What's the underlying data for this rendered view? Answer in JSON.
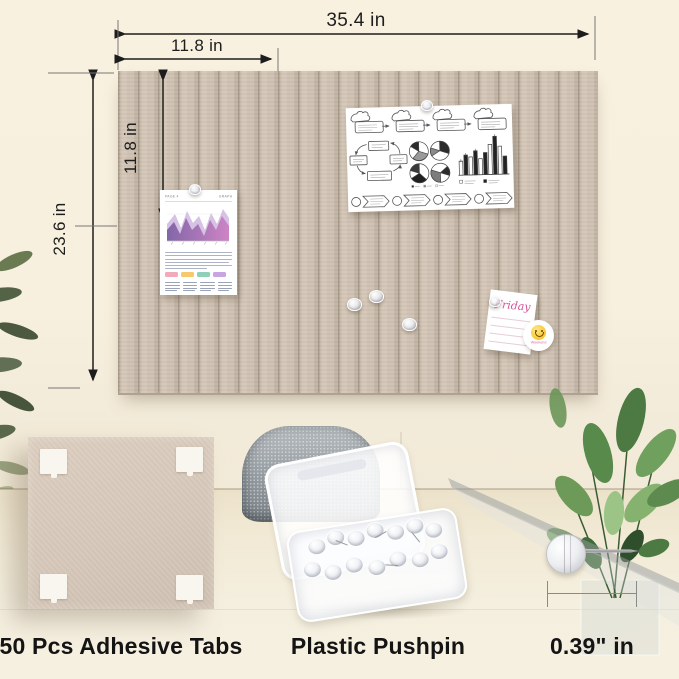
{
  "annotations": {
    "board_width": "35.4 in",
    "panel_width": "11.8 in",
    "panel_height": "11.8 in",
    "board_height": "23.6 in"
  },
  "board": {
    "slat_color": "#cfc2b3",
    "groove_color": "#a69888",
    "slat_count": 24
  },
  "pinned_items": {
    "graph_page": {
      "header_left": "PAGE 4",
      "header_right": "GRAPH",
      "ribbon_colors": [
        "#f2a9bb",
        "#f6c96f",
        "#8fd0b8",
        "#c9a4e2"
      ]
    },
    "friday_note": {
      "title": "Friday",
      "sticker_text": "Weekend"
    }
  },
  "products": {
    "adhesive_tabs_label": "50 Pcs Adhesive Tabs",
    "pushpin_box_label": "Plastic Pushpin",
    "pin_size_label": "0.39\" in"
  }
}
